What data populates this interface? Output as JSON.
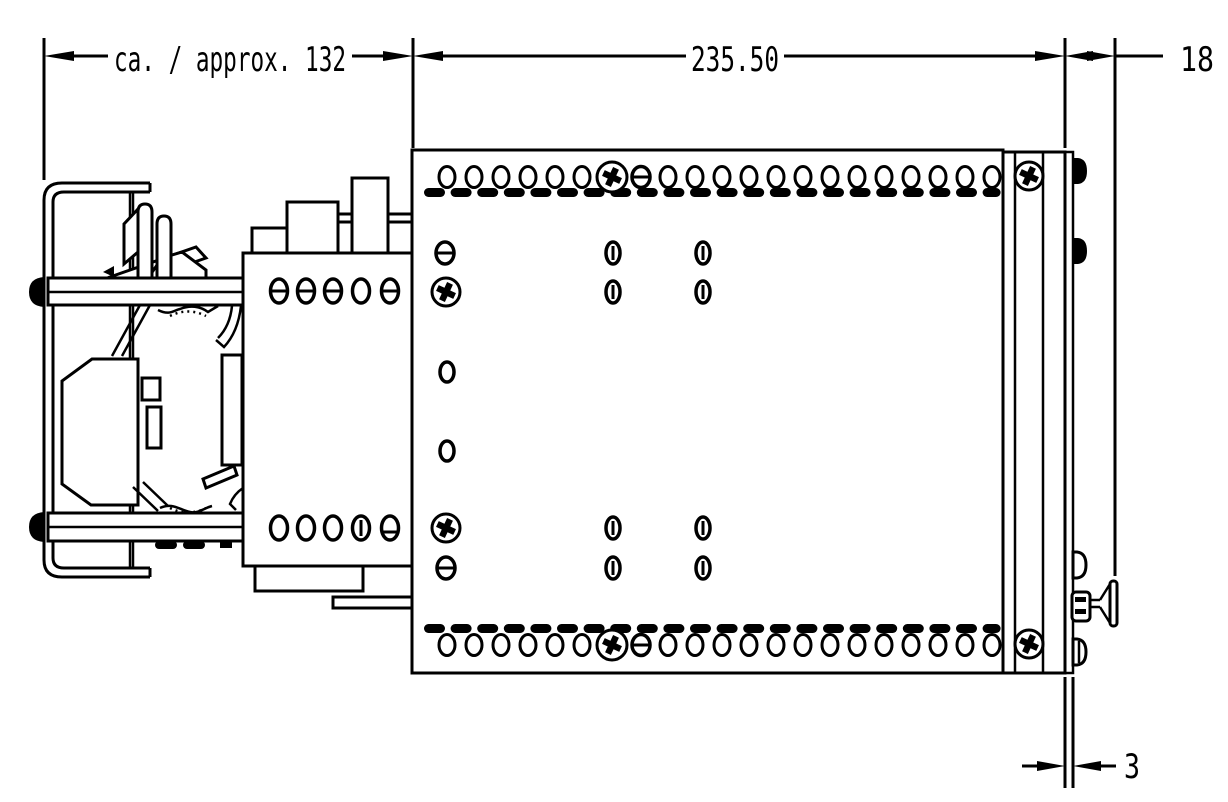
{
  "drawing": {
    "type": "technical-dimension-drawing",
    "view": "side-view-din-rail-module",
    "colors": {
      "line": "#000000",
      "background": "#ffffff"
    },
    "dimensions": {
      "left_width": {
        "label": "ca. / approx. 132"
      },
      "body_width": {
        "label": "235.50"
      },
      "right_depth": {
        "label": "18"
      },
      "plate_thickness": {
        "label": "3"
      }
    }
  }
}
